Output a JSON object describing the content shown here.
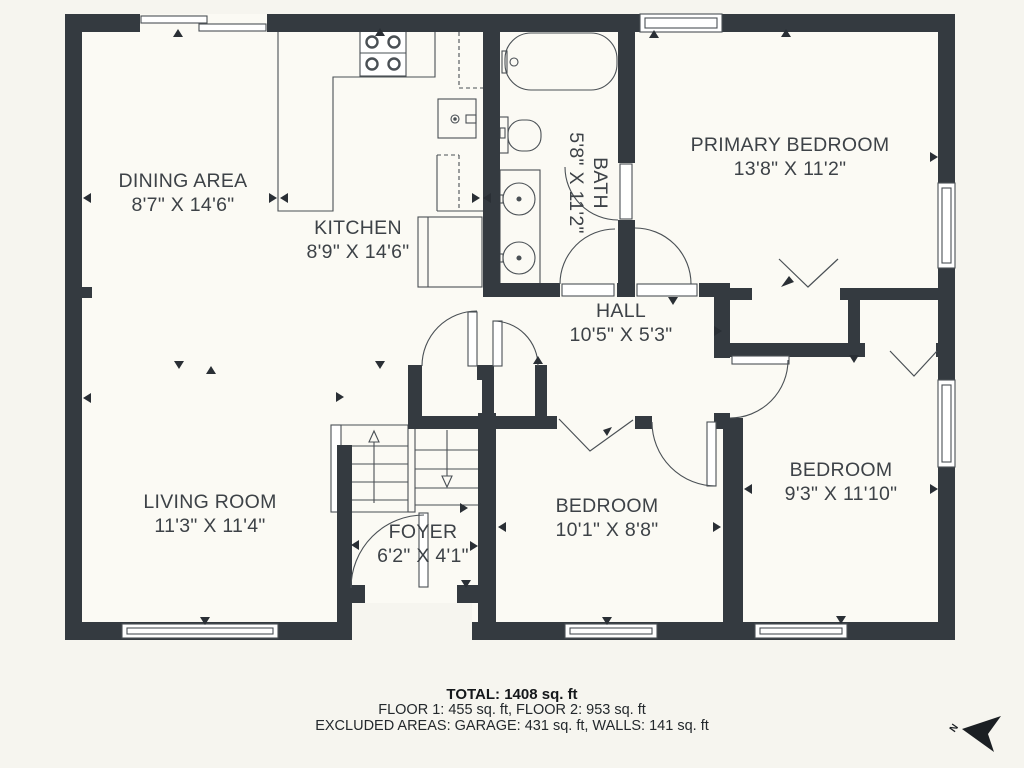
{
  "rooms": [
    {
      "id": "dining-area",
      "name": "DINING AREA",
      "dims": "8'7\" X 14'6\""
    },
    {
      "id": "kitchen",
      "name": "KITCHEN",
      "dims": "8'9\" X 14'6\""
    },
    {
      "id": "bath",
      "name": "BATH",
      "dims": "5'8\" X 11'2\""
    },
    {
      "id": "primary-bedroom",
      "name": "PRIMARY BEDROOM",
      "dims": "13'8\" X 11'2\""
    },
    {
      "id": "hall",
      "name": "HALL",
      "dims": "10'5\" X 5'3\""
    },
    {
      "id": "living-room",
      "name": "LIVING ROOM",
      "dims": "11'3\" X 11'4\""
    },
    {
      "id": "foyer",
      "name": "FOYER",
      "dims": "6'2\" X 4'1\""
    },
    {
      "id": "bedroom-1",
      "name": "BEDROOM",
      "dims": "10'1\" X 8'8\""
    },
    {
      "id": "bedroom-2",
      "name": "BEDROOM",
      "dims": "9'3\" X 11'10\""
    }
  ],
  "footer": {
    "total": "TOTAL: 1408 sq. ft",
    "floors": "FLOOR 1: 455 sq. ft, FLOOR 2: 953 sq. ft",
    "excluded": "EXCLUDED AREAS: GARAGE: 431 sq. ft, WALLS: 141 sq. ft"
  },
  "compass": {
    "label": "N"
  },
  "icons": [
    "north-arrow-icon",
    "stove-icon",
    "kitchen-sink-icon",
    "refrigerator-icon",
    "bathtub-icon",
    "toilet-icon",
    "vanity-sinks-icon",
    "stairs-icon"
  ],
  "colors": {
    "wall": "#343a40",
    "line": "#4a5055",
    "text": "#3d4247",
    "background": "#f6f5ef",
    "floor": "#fbfaf4"
  }
}
